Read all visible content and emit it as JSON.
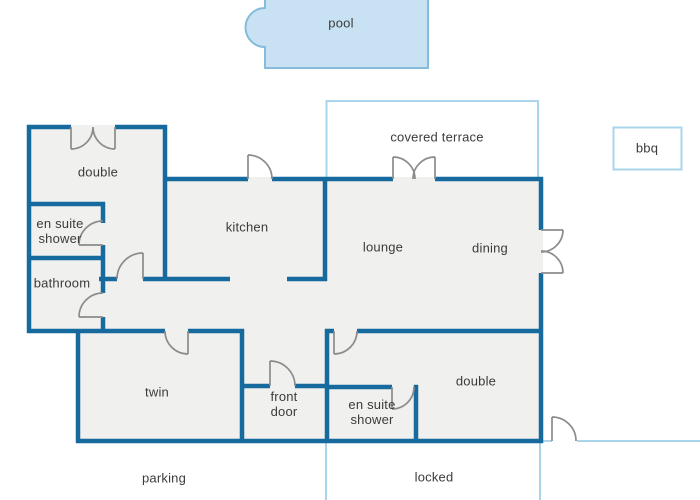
{
  "floor_plan": {
    "labels": {
      "pool": "pool",
      "covered_terrace": "covered terrace",
      "bbq": "bbq",
      "bedroom_double_1": "double",
      "en_suite_shower_1": "en suite shower",
      "bathroom": "bathroom",
      "kitchen": "kitchen",
      "lounge": "lounge",
      "dining": "dining",
      "twin": "twin",
      "front_door": "front door",
      "en_suite_shower_2": "en suite shower",
      "bedroom_double_2": "double",
      "parking": "parking",
      "locked": "locked"
    },
    "colors": {
      "wall": "#176a9e",
      "boundary": "#a9d4e9",
      "pool_fill": "#c8e2f4",
      "pool_stroke": "#85bbdb",
      "room_fill": "#f0f0ee",
      "door": "#8c8c8c",
      "text": "#3b3b3b"
    }
  }
}
